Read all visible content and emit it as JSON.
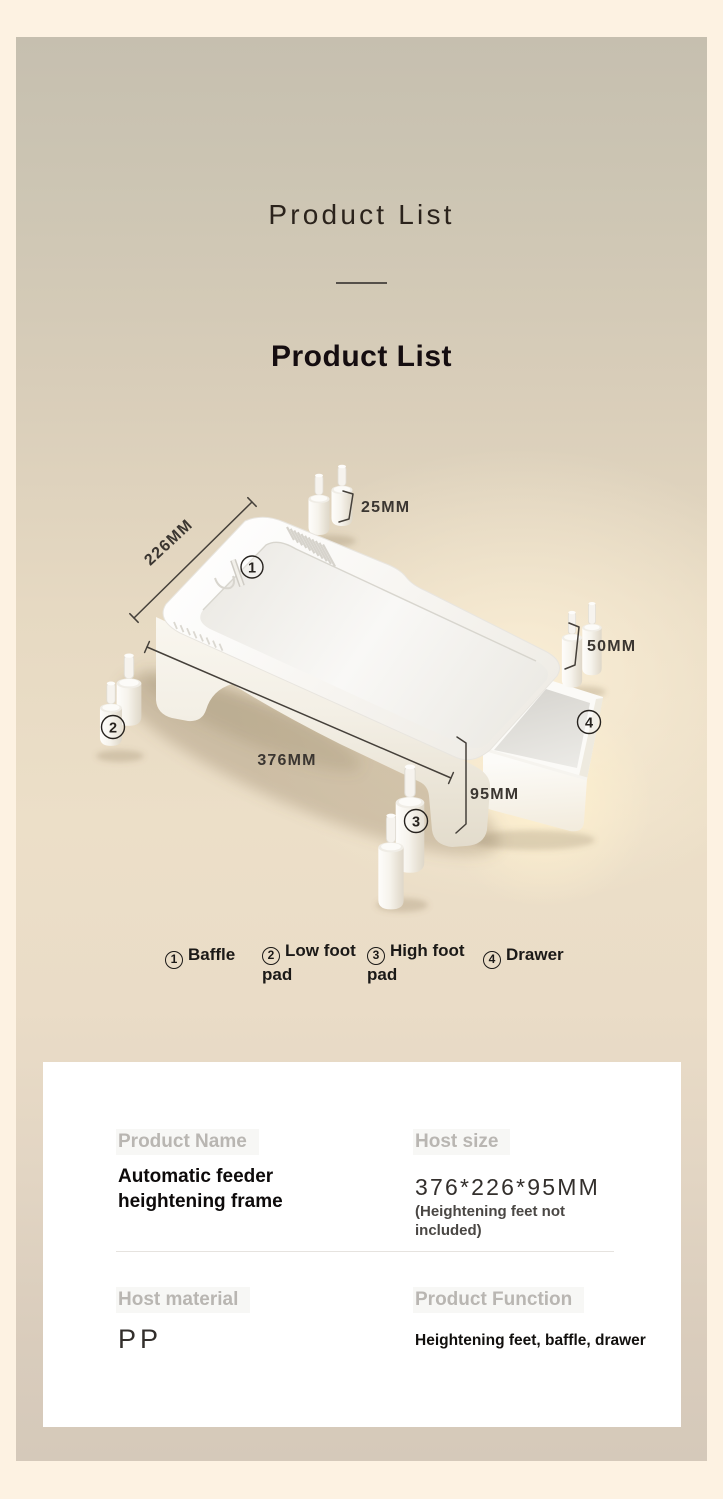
{
  "header": {
    "display_title": "Product List",
    "section_title": "Product List"
  },
  "diagram": {
    "dim_width": "226MM",
    "dim_length": "376MM",
    "dim_height": "95MM",
    "dim_low_foot": "25MM",
    "dim_high_foot": "50MM",
    "legend": [
      {
        "num": "1",
        "label": "Baffle"
      },
      {
        "num": "2",
        "label": "Low foot pad"
      },
      {
        "num": "3",
        "label": "High foot pad"
      },
      {
        "num": "4",
        "label": "Drawer"
      }
    ]
  },
  "spec_card": {
    "product_name_label": "Product Name",
    "product_name_value": "Automatic feeder heightening frame",
    "host_size_label": "Host size",
    "host_size_value": "376*226*95MM",
    "host_size_note": "(Heightening feet not included)",
    "host_material_label": "Host material",
    "host_material_value": "PP",
    "product_function_label": "Product Function",
    "product_function_value": "Heightening feet, baffle, drawer"
  },
  "colors": {
    "outer_bg": "#fdf2e2",
    "panel_top": "#c6bfaf",
    "panel_warm": "#ecdfc8",
    "panel_bottom": "#d5c9ba",
    "card_bg": "#ffffff",
    "title_ink": "#150d10",
    "dim_ink": "#3b3631",
    "muted_label": "#b9b6b2",
    "product_white": "#fbfaf7"
  }
}
